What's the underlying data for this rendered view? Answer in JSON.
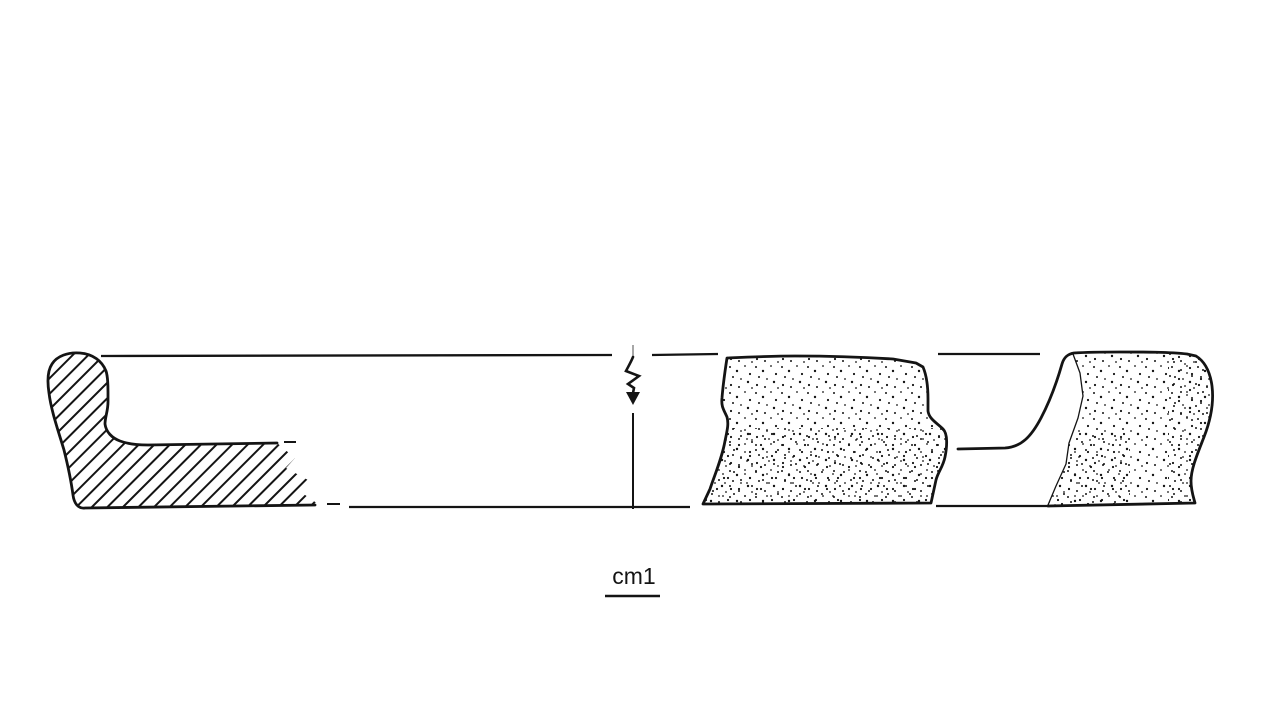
{
  "figure": {
    "kind": "archaeological-pottery-profile-and-sherd-drawing",
    "ink_color": "#141414",
    "background_color": "#ffffff",
    "scale_bar": {
      "label": "cm1",
      "unit_length_px": 55
    },
    "parts": [
      {
        "name": "rim-profile-section",
        "texture": "diagonal-hatching",
        "position": "left"
      },
      {
        "name": "rim-stance-line-top",
        "texture": "solid-line"
      },
      {
        "name": "base-line-bottom",
        "texture": "solid-line"
      },
      {
        "name": "center-axis-break-arrow",
        "texture": "zigzag-arrow",
        "position": "center"
      },
      {
        "name": "body-sherd-exterior",
        "texture": "stipple",
        "position": "center-right"
      },
      {
        "name": "rim-sherd-profile-and-exterior",
        "texture": "outline-plus-stipple",
        "position": "right"
      }
    ]
  }
}
